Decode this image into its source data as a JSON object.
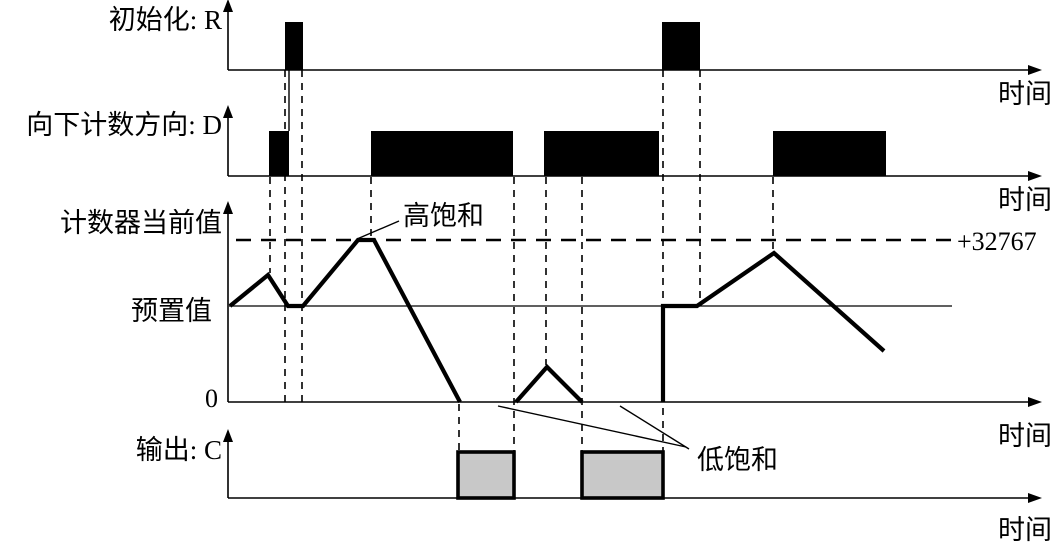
{
  "labels": {
    "r_axis": "初始化: R",
    "d_axis": "向下计数方向: D",
    "counter_axis": "计数器当前值",
    "preset": "预置值",
    "zero": "0",
    "output_axis": "输出: C",
    "time": "时间",
    "high_saturation": "高饱和",
    "low_saturation": "低饱和",
    "max_value": "+32767"
  },
  "colors": {
    "ink": "#000000",
    "background": "#ffffff",
    "pulse_fill": "#000000",
    "output_pulse_fill": "#c8c8c8"
  },
  "chart_data": {
    "type": "timing-diagram",
    "x_axis_label": "时间",
    "rows": [
      {
        "id": "R",
        "label": "初始化: R",
        "kind": "digital",
        "pulse_intervals_px": [
          [
            285,
            303
          ],
          [
            662,
            700
          ]
        ]
      },
      {
        "id": "D",
        "label": "向下计数方向: D",
        "kind": "digital",
        "pulse_intervals_px": [
          [
            269,
            289
          ],
          [
            371,
            513
          ],
          [
            544,
            659
          ],
          [
            773,
            886
          ]
        ]
      },
      {
        "id": "counter",
        "label": "计数器当前值",
        "kind": "analog",
        "levels": {
          "zero": "0",
          "preset": "预置值",
          "max": "+32767"
        },
        "behavior": "counts up to +32767 (high saturation), down to 0 (low saturation); reset loads preset"
      },
      {
        "id": "C",
        "label": "输出: C",
        "kind": "digital",
        "pulse_intervals_px": [
          [
            458,
            514
          ],
          [
            582,
            663
          ]
        ]
      }
    ],
    "annotations": [
      {
        "text": "高饱和",
        "points_to": "counter plateau at +32767"
      },
      {
        "text": "低饱和",
        "points_to": "counter flat segments at 0"
      },
      {
        "text": "+32767",
        "points_to": "upper saturation dashed line"
      }
    ]
  },
  "geometry": {
    "axes": [
      {
        "x": 228,
        "oy": 70,
        "top": 12,
        "right": 1028
      },
      {
        "x": 228,
        "oy": 176,
        "top": 118,
        "right": 1028
      },
      {
        "x": 228,
        "oy": 402,
        "top": 214,
        "right": 1028
      },
      {
        "x": 228,
        "oy": 498,
        "top": 442,
        "right": 1028
      }
    ],
    "r_pulses": {
      "y1": 22,
      "y2": 70,
      "spans": [
        [
          285,
          303
        ],
        [
          662,
          700
        ]
      ]
    },
    "d_pulses": {
      "y1": 131,
      "y2": 176,
      "spans": [
        [
          269,
          289
        ],
        [
          371,
          513
        ],
        [
          544,
          659
        ],
        [
          773,
          886
        ]
      ]
    },
    "c_pulses": {
      "y1": 452,
      "y2": 498,
      "spans": [
        [
          458,
          514
        ],
        [
          582,
          663
        ]
      ]
    },
    "max_dash_line": {
      "y": 240,
      "x1": 236,
      "x2": 952
    },
    "preset_line": {
      "y": 306,
      "x1": 229,
      "x2": 952
    },
    "counter_segments": [
      [
        [
          230,
          306
        ],
        [
          268,
          275
        ],
        [
          288,
          306
        ],
        [
          303,
          306
        ],
        [
          358,
          240
        ],
        [
          374,
          240
        ],
        [
          460,
          402
        ]
      ],
      [
        [
          516,
          402
        ],
        [
          547,
          367
        ],
        [
          582,
          402
        ]
      ],
      [
        [
          663,
          402
        ],
        [
          663,
          306
        ],
        [
          697,
          306
        ],
        [
          774,
          253
        ],
        [
          884,
          351
        ]
      ]
    ],
    "dashed_verticals": [
      [
        270,
        177,
        273
      ],
      [
        285,
        70,
        408
      ],
      [
        302,
        70,
        408
      ],
      [
        371,
        177,
        240
      ],
      [
        459,
        404,
        452
      ],
      [
        514,
        177,
        452
      ],
      [
        546,
        177,
        365
      ],
      [
        582,
        177,
        452
      ],
      [
        663,
        70,
        452
      ],
      [
        700,
        70,
        306
      ],
      [
        773,
        177,
        253
      ]
    ],
    "solid_verticals": [
      [
        289,
        70,
        131
      ]
    ],
    "high_sat_pointer": [
      [
        399,
        221
      ],
      [
        357,
        239
      ]
    ],
    "low_sat_pointers": [
      [
        [
          686,
          447
        ],
        [
          498,
          406
        ]
      ],
      [
        [
          689,
          449
        ],
        [
          620,
          406
        ]
      ]
    ]
  }
}
